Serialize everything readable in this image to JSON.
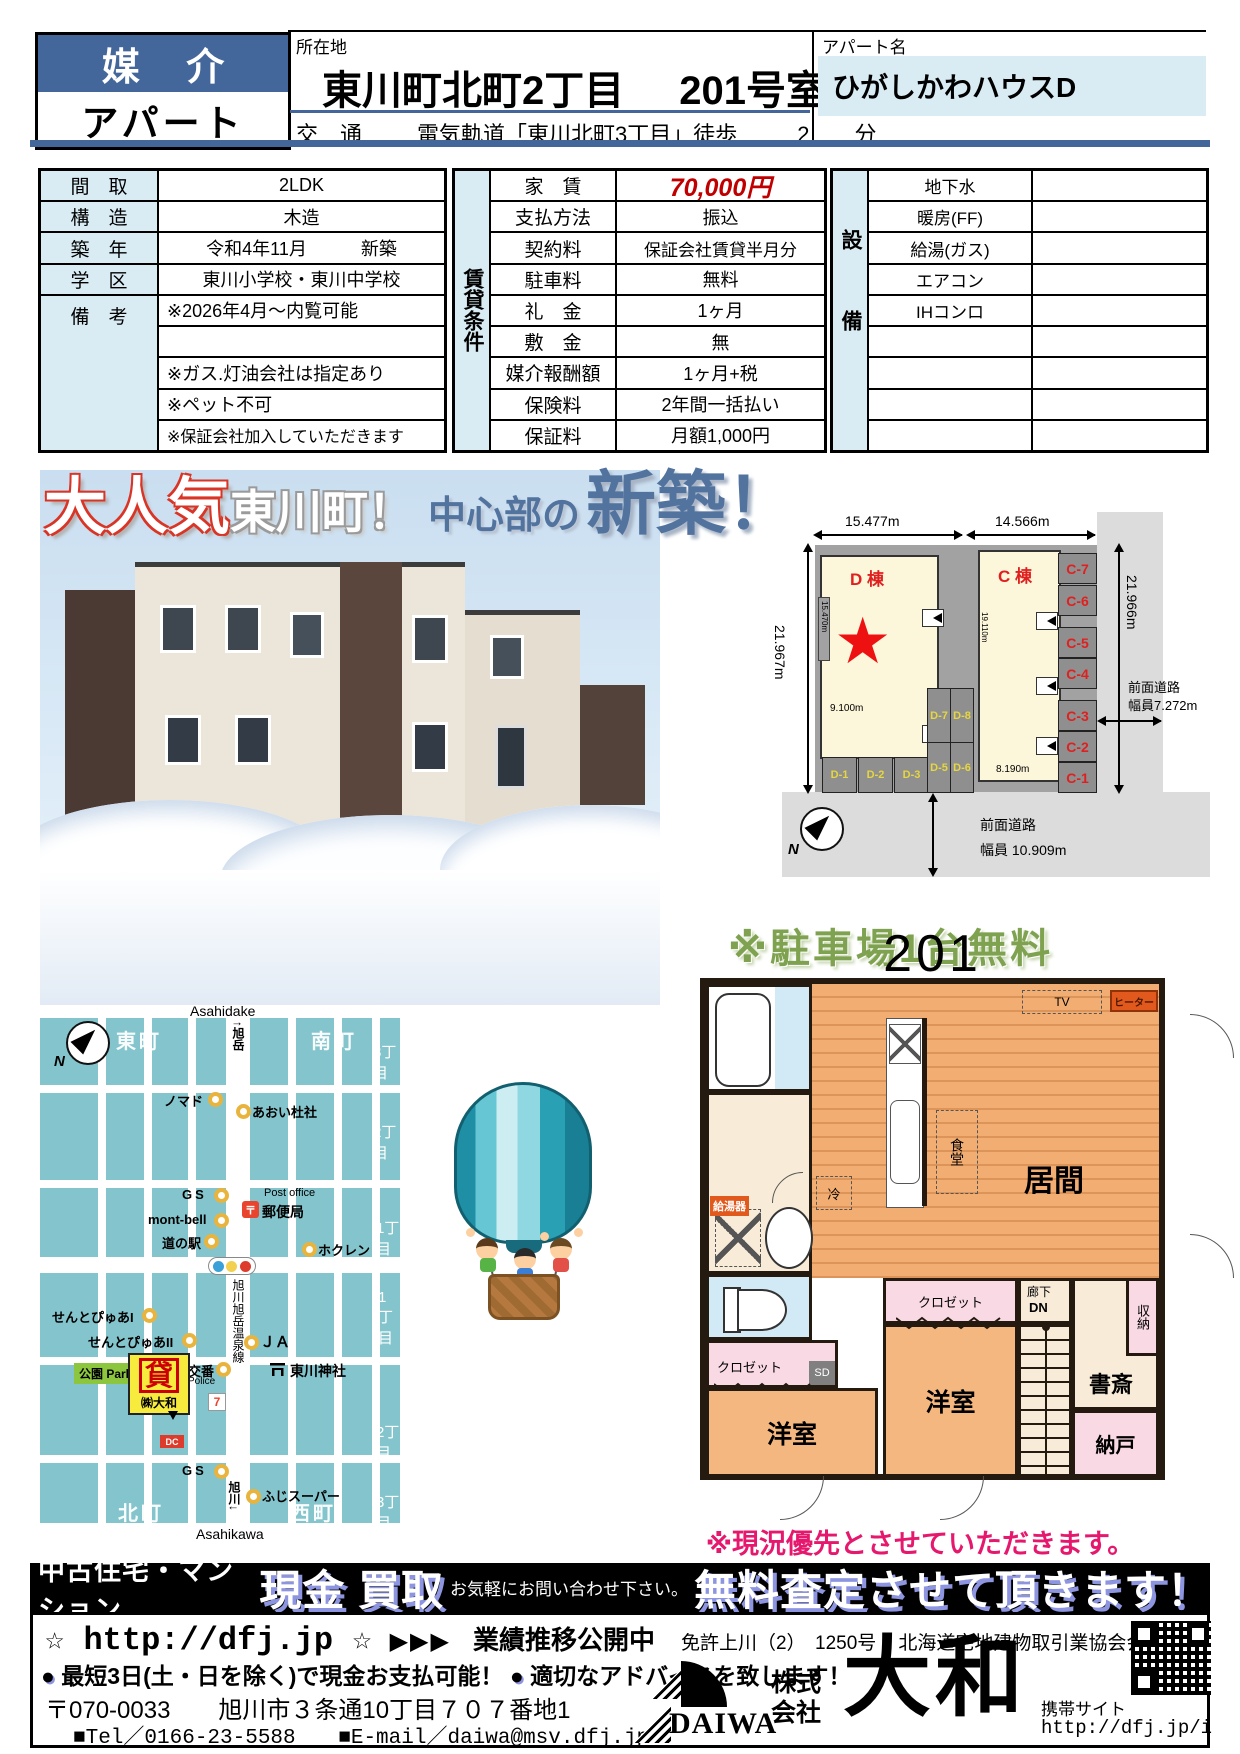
{
  "header": {
    "deal_type": "媒 介",
    "property_type": "アパート",
    "location_label": "所在地",
    "location_value": "東川町北町2丁目",
    "room_no": "201号室",
    "apartment_name_label": "アパート名",
    "apartment_name": "ひがしかわハウスD",
    "access_label": "交　通",
    "access_line": "電気軌道「東川北町3丁目」徒歩",
    "access_minutes": "2",
    "access_unit": "分"
  },
  "overview": {
    "rows": [
      {
        "label": "間　取",
        "value": "2LDK"
      },
      {
        "label": "構　造",
        "value": "木造"
      },
      {
        "label": "築　年",
        "value": "令和4年11月　　　新築"
      },
      {
        "label": "学　区",
        "value": "東川小学校・東川中学校"
      },
      {
        "label": "備　考",
        "value": ""
      }
    ],
    "remarks": [
      "※2026年4月～内覧可能",
      "",
      "※ガス.灯油会社は指定あり",
      "※ペット不可",
      "※保証会社加入していただきます"
    ]
  },
  "rental": {
    "vertical_label": "賃貸条件",
    "rows": [
      {
        "label": "家　賃",
        "value": "70,000円"
      },
      {
        "label": "支払方法",
        "value": "振込"
      },
      {
        "label": "契約料",
        "value": "保証会社賃貸半月分"
      },
      {
        "label": "駐車料",
        "value": "無料"
      },
      {
        "label": "礼　金",
        "value": "1ヶ月"
      },
      {
        "label": "敷　金",
        "value": "無"
      },
      {
        "label": "媒介報酬額",
        "value": "1ヶ月+税"
      },
      {
        "label": "保険料",
        "value": "2年間一括払い"
      },
      {
        "label": "保証料",
        "value": "月額1,000円"
      }
    ]
  },
  "equipment": {
    "vertical_label": "設備",
    "items": [
      "地下水",
      "暖房(FF)",
      "給湯(ガス)",
      "エアコン",
      "IHコンロ"
    ]
  },
  "catch_copy": {
    "part1": "大人気",
    "part2": "東川町！",
    "part3": "中心部の",
    "part4": "新築！"
  },
  "site_plan": {
    "dim_top_left": "15.477m",
    "dim_top_right": "14.566m",
    "dim_left": "21.967m",
    "dim_right": "21.966m",
    "building_d": "D 棟",
    "building_c": "C 棟",
    "dim_d_left": "15.470m",
    "dim_d_width": "9.100m",
    "dim_c_left": "19.110m",
    "dim_c_width": "8.190m",
    "stalls_c": [
      "C-7",
      "C-6",
      "C-5",
      "C-4",
      "C-3",
      "C-2",
      "C-1"
    ],
    "stalls_d_bottom": [
      "D-1",
      "D-2",
      "D-3",
      "D-4"
    ],
    "stalls_d_mid_top": [
      "D-7",
      "D-8"
    ],
    "stalls_d_mid_bottom": [
      "D-5",
      "D-6"
    ],
    "road_right_1": "前面道路",
    "road_right_2": "幅員7.272m",
    "road_bottom_1": "前面道路",
    "road_bottom_2": "幅員 10.909m",
    "compass_n": "N"
  },
  "parking_note": "※駐車場1台無料",
  "map": {
    "compass_n": "N",
    "station_top_en": "Asahidake",
    "station_top_jp": "↑旭岳",
    "areas": {
      "higashimachi": "東町",
      "minamimachi": "南町",
      "kitamachi": "北町",
      "nishimachi": "西町"
    },
    "blocks": {
      "b3_top": "3丁目",
      "b2_top": "2丁目",
      "b1_mid": "1丁目",
      "b1_low": "1丁目",
      "b2_low": "2丁目",
      "b3_bot": "3丁目"
    },
    "pois": {
      "nomado": "ノマド",
      "aoi": "あおい杜社",
      "gs1": "GS",
      "montbell": "mont-bell",
      "michinoeki": "道の駅",
      "postoffice_en": "Post office",
      "post_icon": "〒",
      "postoffice_jp": "郵便局",
      "hokuren": "ホクレン",
      "road_name": "旭川旭岳温泉線",
      "sentpure1": "せんとぴゅあI",
      "sentpure2": "せんとぴゅあII",
      "park": "公園 Park",
      "kashi": "貸",
      "daiwa_co": "㈱大和",
      "koban": "交番",
      "police": "Police",
      "seven": "7",
      "ja": "ＪＡ",
      "shrine": "東川神社",
      "dc": "DC",
      "gs2": "GS",
      "fuji_super": "ふじスーパー",
      "asahikawa_jp": "旭川↓",
      "asahikawa_en": "Asahikawa"
    }
  },
  "floor_plan": {
    "title": "201",
    "rooms": {
      "living": "居間",
      "dining": "食堂",
      "fridge": "冷",
      "tv": "TV",
      "heater": "ヒーター",
      "water_heater": "給湯器",
      "closet1": "クロゼット",
      "closet2": "クロゼット",
      "sd": "SD",
      "youshitsu1": "洋室",
      "youshitsu2": "洋室",
      "hallway": "廊下",
      "dn": "DN",
      "study": "書斎",
      "storage": "収納",
      "nando": "納戸"
    }
  },
  "condition_note": "※現況優先とさせていただきます。",
  "footer": {
    "banner": {
      "left": "中古住宅・マンション",
      "big1": "現金 買取",
      "small": "お気軽にお問い合わせ下さい。",
      "big2": "無料査定させて頂きます！"
    },
    "url_line": {
      "url": "☆ http://dfj.jp ☆",
      "arrows": "▶▶▶",
      "text": "業績推移公開中",
      "license": "免許上川（2）　1250号",
      "member": "北海道宅地建物取引業協会会員"
    },
    "points": {
      "bullet": "●",
      "p1": "最短3日(土・日を除く)で現金お支払可能！",
      "p2": "適切なアドバイスを致します！"
    },
    "address": "〒070-0033　　旭川市３条通10丁目７０７番地1",
    "tel": "■Tel／0166-23-5588",
    "email": "■E-mail／daiwa@msv.dfj.jp",
    "company": {
      "logo": "DAIWA",
      "kabushiki": "株式",
      "kaisha": "会社",
      "name": "大和"
    },
    "mobile": {
      "label": "携帯サイト",
      "url": "http://dfj.jp/i"
    }
  }
}
